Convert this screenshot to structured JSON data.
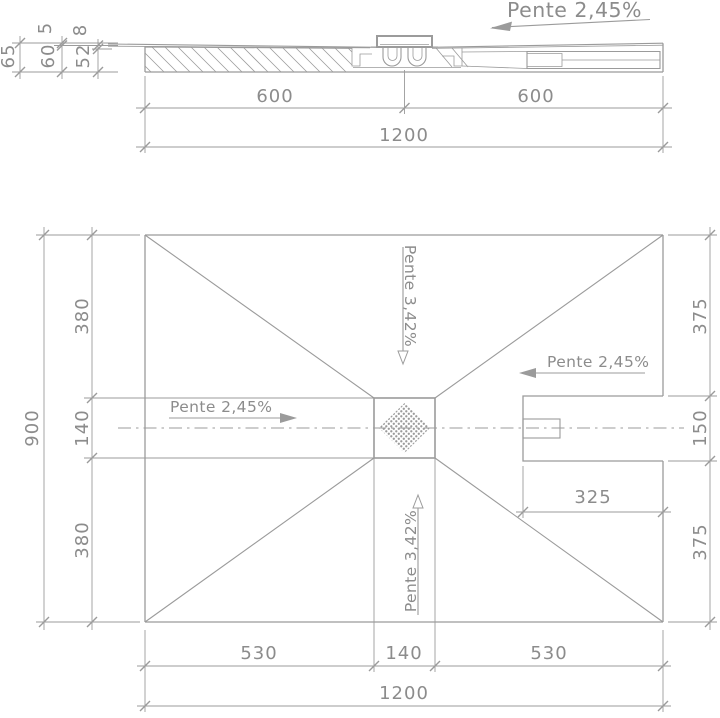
{
  "drawing_type": "technical-dimension-drawing",
  "colors": {
    "line": "#9b9b9b",
    "text": "#8c8c8c",
    "background": "#ffffff"
  },
  "section": {
    "slope_label": "Pente 2,45%",
    "dim_total_height": "65",
    "dim_top_layer": "5",
    "dim_body_height": "60",
    "dim_mid_layer": "8",
    "dim_base_height": "52",
    "dim_left_half": "600",
    "dim_right_half": "600",
    "dim_overall_width": "1200"
  },
  "plan": {
    "slope_left": "Pente 2,45%",
    "slope_right": "Pente 2,45%",
    "slope_top": "Pente 3,42%",
    "slope_bottom": "Pente 3,42%",
    "dim_overall_height": "900",
    "dim_upper_left": "380",
    "dim_channel_left": "140",
    "dim_lower_left": "380",
    "dim_upper_right": "375",
    "dim_notch_height": "150",
    "dim_lower_right": "375",
    "dim_notch_depth": "325",
    "dim_bottom_left": "530",
    "dim_channel_bottom": "140",
    "dim_bottom_right": "530",
    "dim_overall_width": "1200"
  }
}
